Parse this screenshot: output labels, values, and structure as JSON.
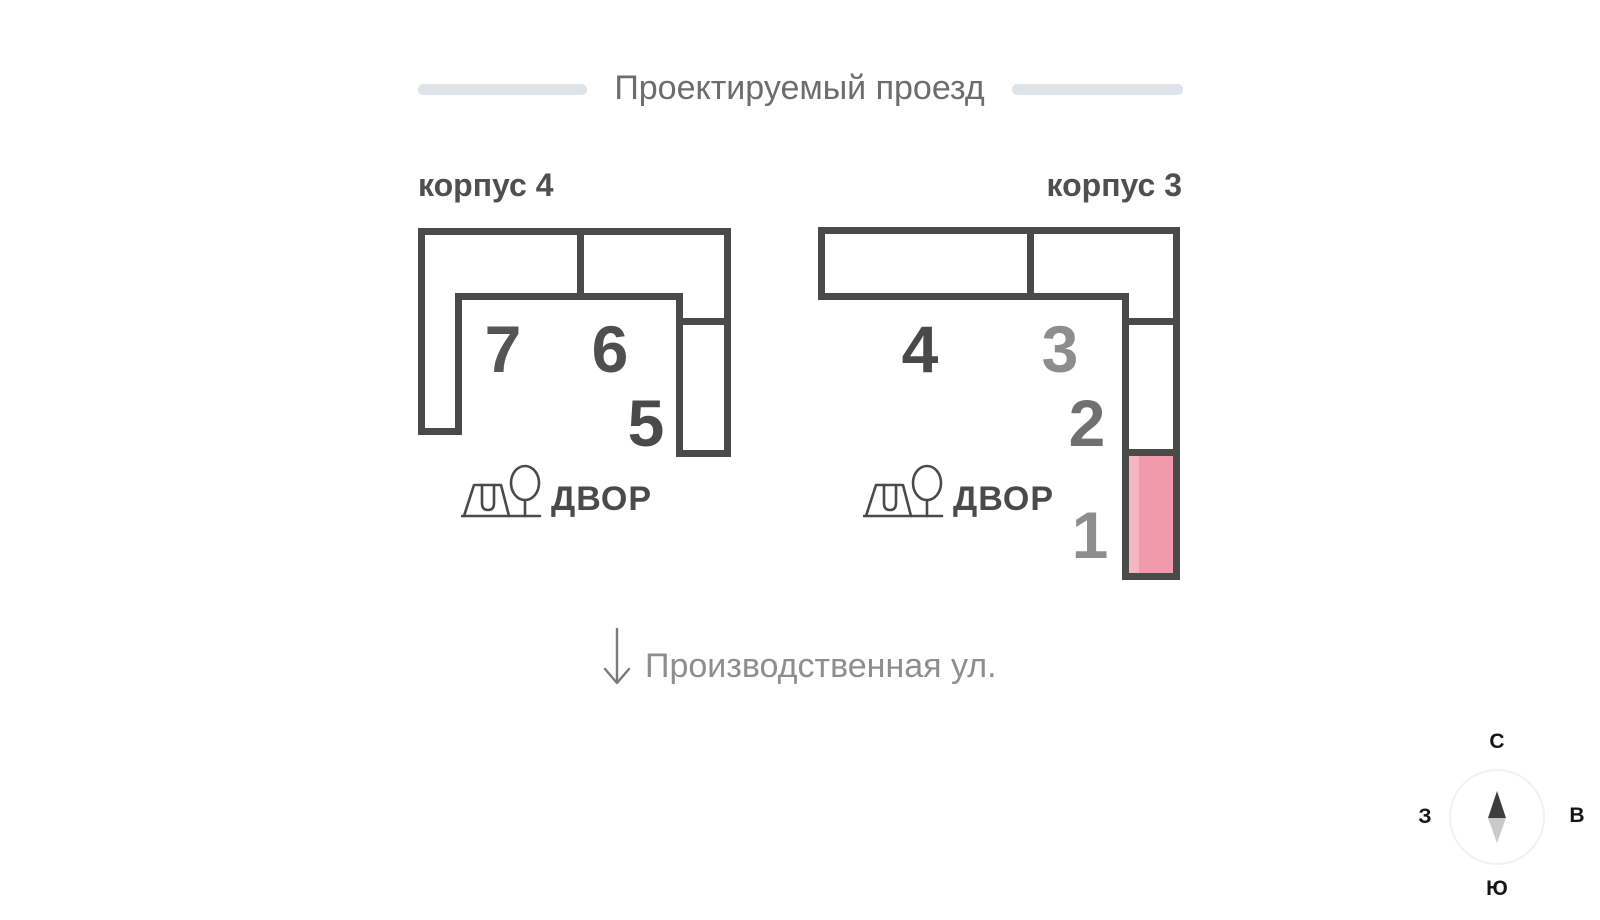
{
  "colors": {
    "outline": "#4a4a4a",
    "highlight": "#f09aab",
    "highlight-light": "#f4b6c2",
    "street-bar": "#dde3e8",
    "title-gray": "#6d6d6d",
    "street-gray": "#8e8e8e"
  },
  "streets": {
    "top": "Проектируемый проезд",
    "bottom": "Производственная ул."
  },
  "buildings": [
    {
      "name": "корпус 4",
      "yard": {
        "label": "ДВОР",
        "icons": [
          "playground-swing-icon",
          "tree-icon"
        ]
      },
      "sections": [
        {
          "label": "7",
          "color": "#555555"
        },
        {
          "label": "6",
          "color": "#4f4f4f"
        },
        {
          "label": "5",
          "color": "#4a4a4a"
        }
      ]
    },
    {
      "name": "корпус 3",
      "yard": {
        "label": "ДВОР",
        "icons": [
          "playground-swing-icon",
          "tree-icon"
        ]
      },
      "sections": [
        {
          "label": "4",
          "color": "#494949"
        },
        {
          "label": "3",
          "color": "#8d8d8d"
        },
        {
          "label": "2",
          "color": "#707070"
        },
        {
          "label": "1",
          "color": "#8d8d8d",
          "highlighted": true
        }
      ]
    }
  ],
  "compass": {
    "north": "С",
    "east": "В",
    "south": "Ю",
    "west": "З"
  }
}
